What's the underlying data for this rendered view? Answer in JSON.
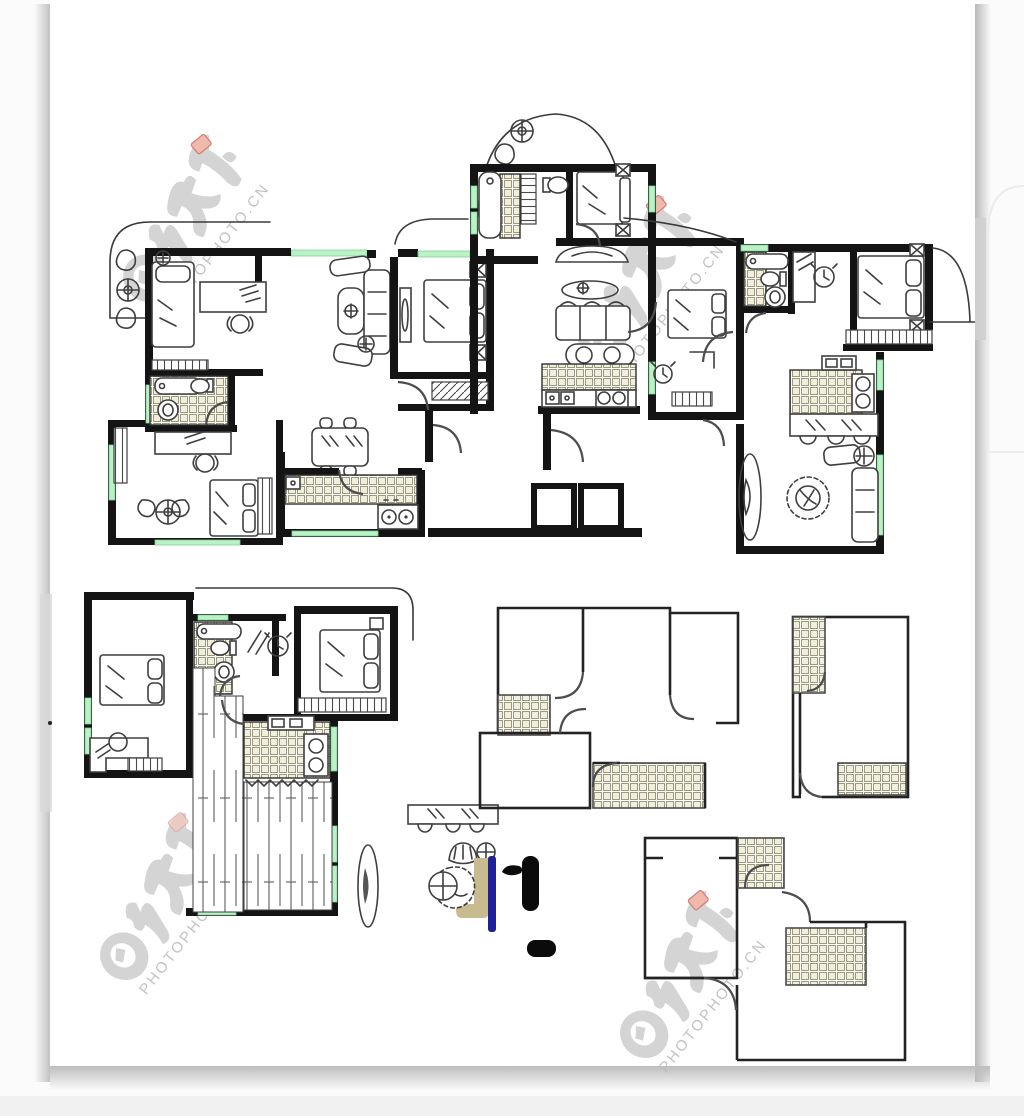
{
  "image": {
    "type": "floor-plan-collage",
    "description-icons": [
      "apartment-floor-plan",
      "furnished-plan",
      "outline-plan"
    ],
    "sheet_background": "#ffffff",
    "canvas_background": "#fbfbfb"
  },
  "watermark": {
    "brand_cn": "图行天下",
    "brand_url": "PHOTOPHOTO.CN",
    "text_color": "#bdbdbd",
    "logo_color": "#c8c8c8",
    "seal_color": "#f0b2a6",
    "instances": [
      {
        "x": 193,
        "y": 222,
        "rotation": -52
      },
      {
        "x": 648,
        "y": 283,
        "rotation": -52
      },
      {
        "x": 170,
        "y": 900,
        "rotation": -52
      },
      {
        "x": 690,
        "y": 978,
        "rotation": -52
      }
    ]
  },
  "palette": {
    "wall": "#141414",
    "thin_wall": "#232323",
    "furniture_line": "#3f3f3f",
    "door_line": "#4d4d4d",
    "window_green": "#b9f2c4",
    "tile_fill": "#f1efdc",
    "tile_grid": "#9b997e",
    "navy": "#20209a",
    "tan": "#c8bb90",
    "black_furniture": "#0b0b0b",
    "page_shadow": "#c7c7c7"
  },
  "plans": [
    {
      "id": "top-left-apartment",
      "icons": [
        "balcony-plants",
        "single-bed",
        "desk",
        "chair",
        "wardrobe",
        "bathtub",
        "toilet",
        "washbasin",
        "bookshelf",
        "double-bed",
        "round-table",
        "sofa",
        "armchairs",
        "coffee-table",
        "dining-table",
        "kitchen-counter",
        "stove"
      ]
    },
    {
      "id": "top-middle-apartment",
      "icons": [
        "balcony-plants",
        "bathtub",
        "staircase",
        "toilet",
        "double-bed",
        "wardrobe",
        "vanity",
        "rug",
        "sofa",
        "spa-tub",
        "kitchen-counter",
        "stove",
        "sink",
        "desk",
        "alarm-clock"
      ]
    },
    {
      "id": "top-right-apartment",
      "icons": [
        "bathtub",
        "toilet",
        "washbasin",
        "desk",
        "alarm-clock",
        "double-bed",
        "wardrobe",
        "kitchen-counter",
        "stove",
        "sink",
        "bar-table",
        "stools",
        "rug",
        "armchair",
        "plant",
        "sofa"
      ]
    },
    {
      "id": "bottom-left-apartment",
      "icons": [
        "double-bed",
        "desk",
        "chair",
        "wardrobe",
        "bathtub",
        "toilet",
        "washbasin",
        "mirror-marks",
        "alarm-clock",
        "plank-floor",
        "kitchen-counter",
        "stove",
        "sink",
        "rug"
      ]
    },
    {
      "id": "bottom-middle-outline",
      "icons": [
        "tiled-floor",
        "door-arcs"
      ]
    },
    {
      "id": "middle-right-outline",
      "icons": [
        "tiled-floor",
        "door-arcs"
      ]
    },
    {
      "id": "bottom-right-outline",
      "icons": [
        "tiled-floor",
        "door-arcs"
      ]
    },
    {
      "id": "furniture-vignette",
      "icons": [
        "mirror-console",
        "flower-bowl",
        "person-figure",
        "tan-chair",
        "navy-board",
        "black-bench",
        "plant"
      ]
    },
    {
      "id": "elevator-core",
      "icons": [
        "elevator-shaft",
        "elevator-shaft"
      ]
    }
  ]
}
